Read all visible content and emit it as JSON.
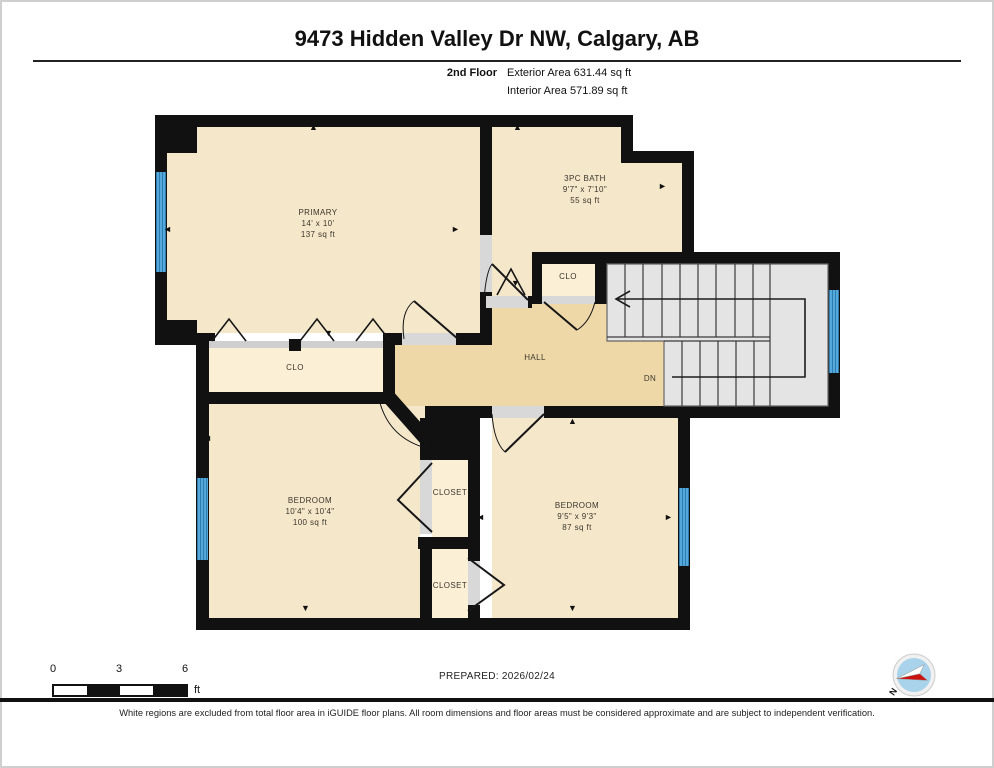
{
  "header": {
    "title": "9473 Hidden Valley Dr NW, Calgary, AB",
    "floor_label": "2nd Floor",
    "exterior_area": "Exterior Area 631.44 sq ft",
    "interior_area": "Interior Area 571.89 sq ft"
  },
  "rooms": {
    "primary": {
      "name": "PRIMARY",
      "dims": "14' x 10'",
      "area": "137 sq ft"
    },
    "bath": {
      "name": "3PC BATH",
      "dims": "9'7\" x 7'10\"",
      "area": "55 sq ft"
    },
    "closet_hall": {
      "name": "CLO"
    },
    "hall": {
      "name": "HALL"
    },
    "stairs": {
      "down_label": "DN"
    },
    "closet_primary": {
      "name": "CLO"
    },
    "bedroom_left": {
      "name": "BEDROOM",
      "dims": "10'4\" x 10'4\"",
      "area": "100 sq ft"
    },
    "closet_upper": {
      "name": "CLOSET"
    },
    "closet_lower": {
      "name": "CLOSET"
    },
    "bedroom_right": {
      "name": "BEDROOM",
      "dims": "9'5\" x 9'3\"",
      "area": "87 sq ft"
    }
  },
  "icons": {
    "arrow_up": "▲",
    "arrow_down": "▼",
    "arrow_left": "◄",
    "arrow_right": "►"
  },
  "compass": {
    "north_label": "N"
  },
  "scale_bar": {
    "tick_0": "0",
    "tick_3": "3",
    "tick_6": "6",
    "unit": "ft"
  },
  "footer": {
    "prepared": "PREPARED: 2026/02/24",
    "disclaimer": "White regions are excluded from total floor area in iGUIDE floor plans. All room dimensions and floor areas must be considered approximate and are subject to independent verification."
  },
  "colors": {
    "wall": "#111111",
    "room_fill": "#f5e7ca",
    "hall_fill": "#eed8a8",
    "closet_fill": "#fbf0d6",
    "stairs_fill": "#e4e4e4",
    "window_blue": "#4da0d0",
    "opening_grey": "#d8d8d8"
  }
}
